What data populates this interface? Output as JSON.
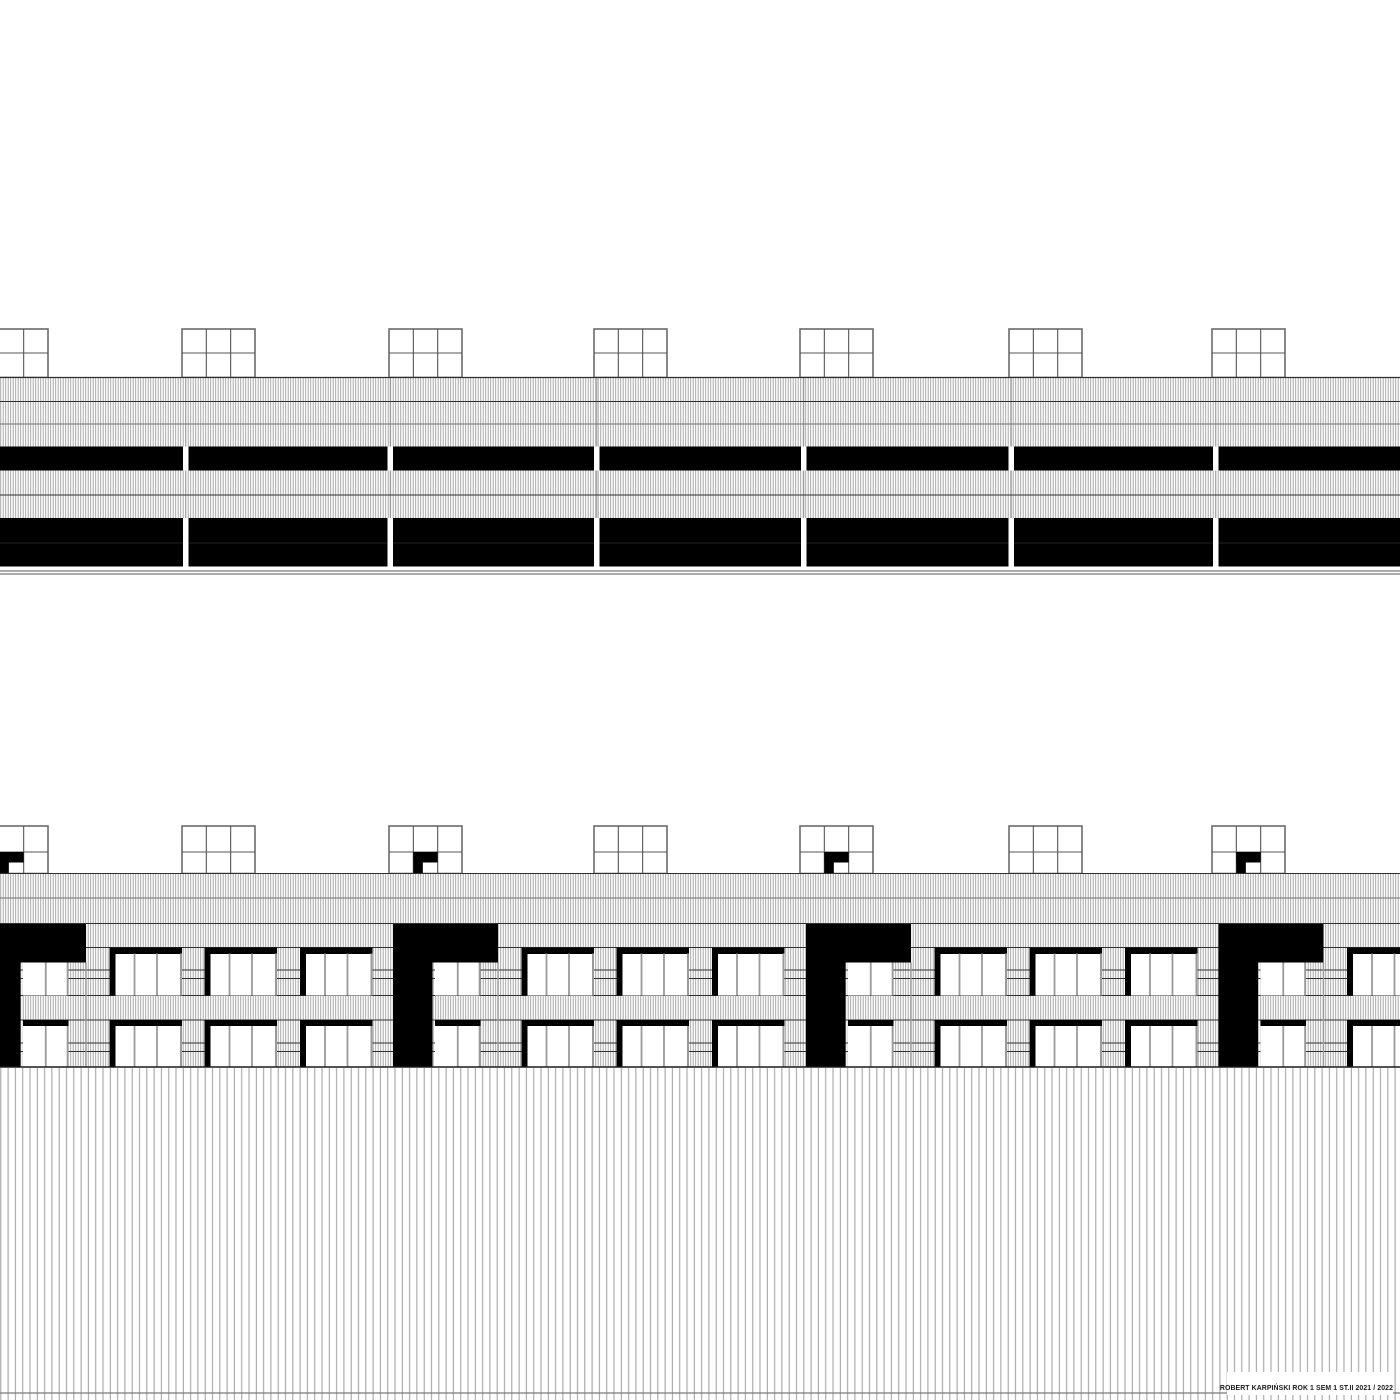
{
  "canvas": {
    "width": 1400,
    "height": 1400,
    "background": "#ffffff"
  },
  "title_block": {
    "text": "ROBERT KARPIŃSKI ROK 1 SEM 1 ST.II 2021 / 2022",
    "color": "#1a1a1a"
  },
  "palette": {
    "black": "#000000",
    "white": "#ffffff",
    "line_strong": "#2e2e2e",
    "line_soft": "#6f6f6f",
    "line_faint": "#9a9a9a",
    "hatch_fine": "#a0a0a0",
    "hatch_fence": "#9c9c9c",
    "mullion": "#9a9a9a",
    "frame_outer": "#6b6b6b",
    "frame_inner": "#555555",
    "ground_double": "#7a7a7a",
    "band_inner_line": "#222222"
  },
  "hatch": {
    "fine_spacing": 2.5,
    "fine_width": 0.9,
    "fence_spacing": 7.3,
    "fence_width": 1.0
  },
  "skylights": {
    "lefts": [
      -25,
      182,
      389,
      594,
      800,
      1009,
      1212
    ],
    "width": 73,
    "cols": 3
  },
  "top_elevation": {
    "skylight_top": 329,
    "skylight_mid": 353,
    "roof": 377.5,
    "hatch_region": {
      "y1": 377.5,
      "y2": 566.5
    },
    "hlines": [
      {
        "y": 401.5,
        "c": "line_strong"
      },
      {
        "y": 424,
        "c": "line_soft"
      },
      {
        "y": 495,
        "c": "line_strong"
      }
    ],
    "bands": [
      {
        "y": 446.5,
        "h": 24
      },
      {
        "y": 518,
        "h": 48.5,
        "inner_line_y": 543
      }
    ],
    "gaps": {
      "lefts": [
        183,
        387.5,
        594,
        801,
        1008.5,
        1213
      ],
      "width": 5.5
    },
    "seam_offset": 2.75,
    "ground_lines": [
      571,
      574
    ]
  },
  "bottom_elevation": {
    "skylight_top": 826,
    "skylight_mid": 852,
    "roof": 873.5,
    "gamma_skylights": [
      0,
      2,
      4,
      6
    ],
    "gamma_bar_h": 10.5,
    "gamma_leg_w": 9.5,
    "hatch_region": {
      "y1": 873.5,
      "y2": 1067
    },
    "hlines": [
      {
        "y": 873.5,
        "c": "line_strong"
      },
      {
        "y": 898,
        "c": "line_soft"
      },
      {
        "y": 923.5,
        "c": "line_strong"
      },
      {
        "y": 947.5,
        "c": "line_strong"
      },
      {
        "y": 970,
        "c": "line_strong"
      },
      {
        "y": 978.5,
        "c": "line_strong"
      },
      {
        "y": 995.5,
        "c": "line_strong"
      },
      {
        "y": 1020,
        "c": "line_strong"
      },
      {
        "y": 1043,
        "c": "line_strong"
      },
      {
        "y": 1051.5,
        "c": "line_strong"
      }
    ],
    "towers": {
      "lefts": [
        -19,
        393,
        806,
        1218.5
      ],
      "bar_width": 105,
      "bar_top": 924,
      "bar_bottom": 962.5,
      "leg_width": 39.5,
      "leg_bottom": 1067
    },
    "windows": {
      "upper": {
        "head_y": 947.5,
        "head_h": 6.5,
        "top": 953.5,
        "sill": 995.5
      },
      "lower": {
        "head_y": 1020,
        "head_h": 6,
        "top": 1026,
        "sill": 1067
      },
      "recessed": {
        "offset": 42,
        "width": 45.5,
        "upper_top": 962.5
      },
      "standard": {
        "offsets": [
          128.5,
          223.5,
          319
        ],
        "width": 72.5,
        "jamb_w": 6,
        "mullion_fr": [
          0.345,
          0.655
        ],
        "right_edge_w": 2
      }
    },
    "ground_y": 1067,
    "fence": {
      "y1": 1068,
      "y2": 1400,
      "line_y": 1393
    }
  }
}
